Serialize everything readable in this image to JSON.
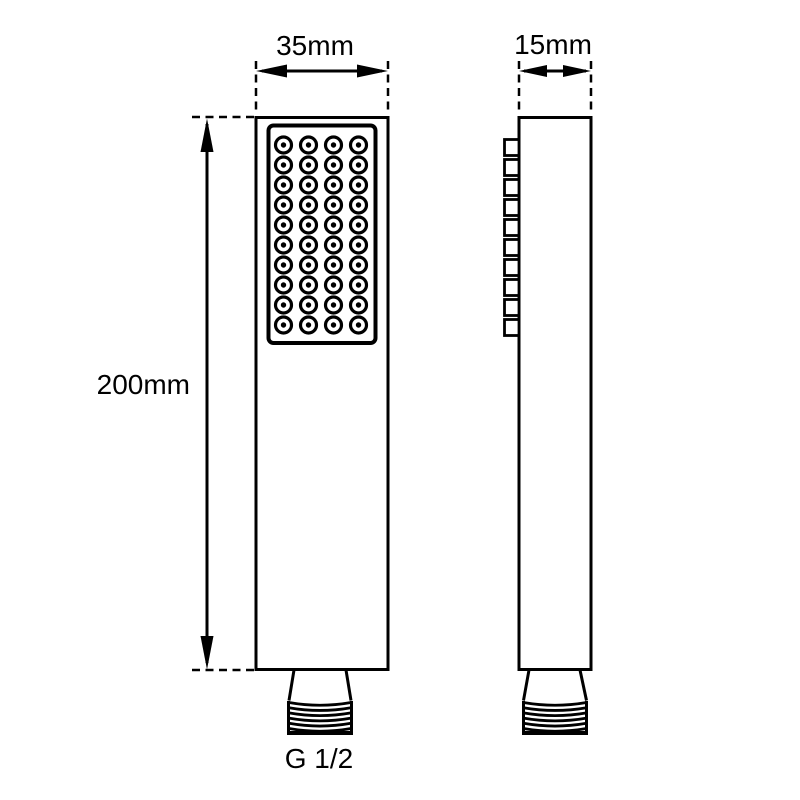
{
  "drawing": {
    "labels": {
      "width": "35mm",
      "depth": "15mm",
      "height": "200mm",
      "thread": "G 1/2"
    },
    "colors": {
      "line": "#000000",
      "background": "#ffffff"
    },
    "front_view": {
      "nozzle_rows": 10,
      "nozzle_columns": 4
    },
    "side_view": {
      "nozzle_squares": 10
    },
    "thread": {
      "ridge_lines": 6
    }
  }
}
